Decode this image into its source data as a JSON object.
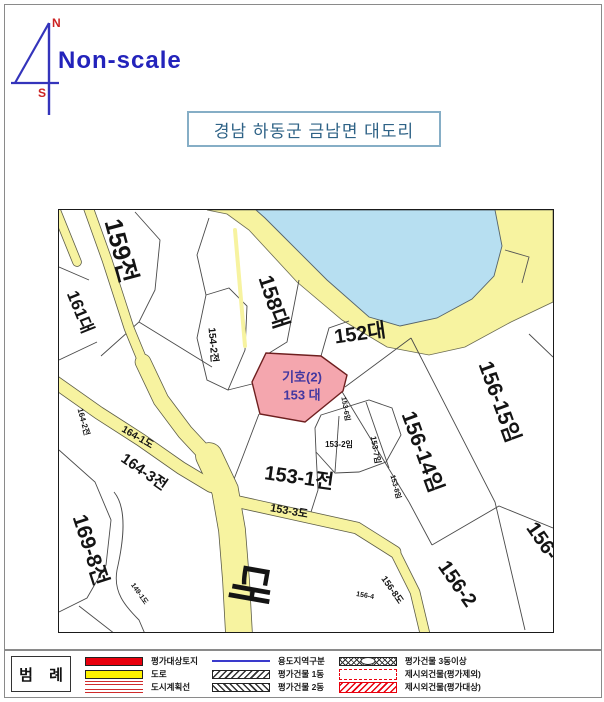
{
  "header": {
    "scale_label": "Non-scale",
    "compass": {
      "north": "N",
      "south": "S"
    },
    "title": "경남 하동군 금남면 대도리"
  },
  "map": {
    "subject": {
      "line1": "기호(2)",
      "line2": "153 대"
    },
    "subject_fill": "#f4a6ae",
    "water_color": "#b7dff1",
    "road_color": "#f7f3a0",
    "labels": [
      {
        "text": "159전",
        "x": 61,
        "y": 41,
        "rot": 75,
        "fs": 25
      },
      {
        "text": "161대",
        "x": 21,
        "y": 102,
        "rot": 68,
        "fs": 17
      },
      {
        "text": "158대",
        "x": 214,
        "y": 92,
        "rot": 72,
        "fs": 21
      },
      {
        "text": "154-2전",
        "x": 153,
        "y": 135,
        "rot": 85,
        "fs": 10
      },
      {
        "text": "152대",
        "x": 301,
        "y": 124,
        "rot": -8,
        "fs": 20
      },
      {
        "text": "156-15임",
        "x": 440,
        "y": 192,
        "rot": 70,
        "fs": 21
      },
      {
        "text": "156-14임",
        "x": 363,
        "y": 242,
        "rot": 70,
        "fs": 21
      },
      {
        "text": "153-1전",
        "x": 240,
        "y": 268,
        "rot": 8,
        "fs": 20
      },
      {
        "text": "153-2임",
        "x": 280,
        "y": 235,
        "rot": 0,
        "fs": 8
      },
      {
        "text": "153-7임",
        "x": 316,
        "y": 240,
        "rot": 80,
        "fs": 8
      },
      {
        "text": "153-6임",
        "x": 286,
        "y": 199,
        "rot": 80,
        "fs": 7
      },
      {
        "text": "153-8임",
        "x": 336,
        "y": 277,
        "rot": 75,
        "fs": 7
      },
      {
        "text": "164-3전",
        "x": 85,
        "y": 262,
        "rot": 35,
        "fs": 15
      },
      {
        "text": "164-1도",
        "x": 78,
        "y": 228,
        "rot": 30,
        "fs": 10
      },
      {
        "text": "164-2전",
        "x": 24,
        "y": 212,
        "rot": 75,
        "fs": 8
      },
      {
        "text": "153-3도",
        "x": 230,
        "y": 302,
        "rot": 10,
        "fs": 11
      },
      {
        "text": "169-8전",
        "x": 31,
        "y": 340,
        "rot": 72,
        "fs": 21
      },
      {
        "text": "149-1도",
        "x": 80,
        "y": 384,
        "rot": 55,
        "fs": 7
      },
      {
        "text": "156-8도",
        "x": 333,
        "y": 380,
        "rot": 55,
        "fs": 9
      },
      {
        "text": "156-4",
        "x": 306,
        "y": 386,
        "rot": 10,
        "fs": 7
      },
      {
        "text": "대",
        "x": 190,
        "y": 374,
        "rot": 100,
        "fs": 44
      },
      {
        "text": "156-2",
        "x": 398,
        "y": 374,
        "rot": 55,
        "fs": 20
      },
      {
        "text": "156-",
        "x": 483,
        "y": 331,
        "rot": 55,
        "fs": 20
      }
    ]
  },
  "legend": {
    "title": "범 례",
    "items": [
      {
        "label": "평가대상토지",
        "symbol": "red-fill"
      },
      {
        "label": "도로",
        "symbol": "yellow-fill"
      },
      {
        "label": "도시계획선",
        "symbol": "red-double-line"
      },
      {
        "label": "용도지역구분",
        "symbol": "blue-line"
      },
      {
        "label": "평가건물 1동",
        "symbol": "hatch-forward"
      },
      {
        "label": "평가건물 2동",
        "symbol": "hatch-back"
      },
      {
        "label": "평가건물 3동이상",
        "symbol": "crisscross-ellipse"
      },
      {
        "label": "제시외건물(평가제외)",
        "symbol": "red-dashed-box"
      },
      {
        "label": "제시외건물(평가대상)",
        "symbol": "red-hatch-box"
      }
    ]
  }
}
